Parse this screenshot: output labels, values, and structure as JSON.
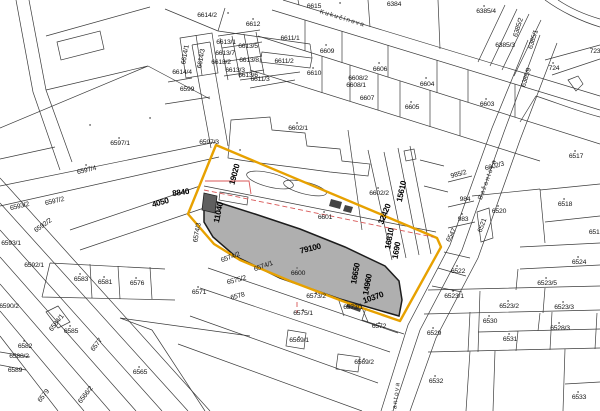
{
  "map": {
    "type": "cadastral-map",
    "colors": {
      "background": "#ffffff",
      "parcel_line": "#3c3c3c",
      "highlight_boundary": "#e7a100",
      "selected_parcel_fill": "#8c8c8c",
      "planning_line_red": "#d85757",
      "label_text": "#141414"
    },
    "streets": [
      {
        "text": "Kukučínova",
        "x": 342,
        "y": 20,
        "rot": 17
      },
      {
        "text": "Bažantova",
        "x": 489,
        "y": 180,
        "rot": -70
      },
      {
        "text": "Bažantova",
        "x": 397,
        "y": 403,
        "rot": -83
      }
    ],
    "measurements": [
      {
        "text": "4050",
        "x": 161,
        "y": 205,
        "rot": -16
      },
      {
        "text": "8840",
        "x": 181,
        "y": 195,
        "rot": -8
      },
      {
        "text": "19020",
        "x": 237,
        "y": 175,
        "rot": -75
      },
      {
        "text": "11040",
        "x": 221,
        "y": 213,
        "rot": -78
      },
      {
        "text": "79100",
        "x": 311,
        "y": 251,
        "rot": -14
      },
      {
        "text": "32420",
        "x": 387,
        "y": 215,
        "rot": -68
      },
      {
        "text": "15610",
        "x": 404,
        "y": 192,
        "rot": -78
      },
      {
        "text": "16810",
        "x": 392,
        "y": 239,
        "rot": -80
      },
      {
        "text": "1690",
        "x": 399,
        "y": 251,
        "rot": -80
      },
      {
        "text": "16650",
        "x": 358,
        "y": 274,
        "rot": -80
      },
      {
        "text": "14960",
        "x": 370,
        "y": 285,
        "rot": -80
      },
      {
        "text": "10370",
        "x": 374,
        "y": 300,
        "rot": -20
      }
    ],
    "parcels": [
      {
        "text": "6614/2",
        "x": 207,
        "y": 17
      },
      {
        "text": "6612",
        "x": 253,
        "y": 26
      },
      {
        "text": "6611/1",
        "x": 290,
        "y": 40
      },
      {
        "text": "6615",
        "x": 314,
        "y": 8
      },
      {
        "text": "6384",
        "x": 394,
        "y": 6
      },
      {
        "text": "6385/4",
        "x": 486,
        "y": 13
      },
      {
        "text": "6385/2",
        "x": 520,
        "y": 28,
        "rot": -72,
        "size": 5.5
      },
      {
        "text": "6385/1",
        "x": 535,
        "y": 40,
        "rot": -72
      },
      {
        "text": "6385/3",
        "x": 505,
        "y": 47,
        "size": 5.5
      },
      {
        "text": "724",
        "x": 554,
        "y": 70
      },
      {
        "text": "723",
        "x": 595,
        "y": 53
      },
      {
        "text": "6385/9",
        "x": 528,
        "y": 78,
        "rot": -72,
        "size": 5
      },
      {
        "text": "6609",
        "x": 327,
        "y": 53
      },
      {
        "text": "6610",
        "x": 314,
        "y": 75
      },
      {
        "text": "6606",
        "x": 380,
        "y": 71
      },
      {
        "text": "6608/2",
        "x": 358,
        "y": 80,
        "size": 5
      },
      {
        "text": "6608/1",
        "x": 356,
        "y": 87,
        "size": 5
      },
      {
        "text": "6607",
        "x": 367,
        "y": 100
      },
      {
        "text": "6604",
        "x": 427,
        "y": 86
      },
      {
        "text": "6605",
        "x": 412,
        "y": 109
      },
      {
        "text": "6603",
        "x": 487,
        "y": 106
      },
      {
        "text": "6614/1",
        "x": 187,
        "y": 55,
        "rot": -80,
        "size": 5.8
      },
      {
        "text": "6614/3",
        "x": 203,
        "y": 59,
        "rot": -80,
        "size": 5.8
      },
      {
        "text": "6614/4",
        "x": 182,
        "y": 74,
        "size": 5.5
      },
      {
        "text": "6599",
        "x": 187,
        "y": 91
      },
      {
        "text": "6613/1",
        "x": 226,
        "y": 44,
        "size": 4.6
      },
      {
        "text": "6613/5",
        "x": 248,
        "y": 48,
        "size": 4.6
      },
      {
        "text": "6613/7",
        "x": 225,
        "y": 55,
        "size": 4.6
      },
      {
        "text": "6613/8",
        "x": 249,
        "y": 62,
        "size": 4.6
      },
      {
        "text": "6613/2",
        "x": 221,
        "y": 64,
        "size": 4.6
      },
      {
        "text": "6613/3",
        "x": 235,
        "y": 72,
        "size": 4.6
      },
      {
        "text": "6613/6",
        "x": 248,
        "y": 77,
        "size": 4.6
      },
      {
        "text": "6611/2",
        "x": 284,
        "y": 63
      },
      {
        "text": "6611/3",
        "x": 260,
        "y": 81,
        "size": 5.5
      },
      {
        "text": "6597/3",
        "x": 209,
        "y": 144
      },
      {
        "text": "6597/1",
        "x": 120,
        "y": 145
      },
      {
        "text": "6597/4",
        "x": 87,
        "y": 172,
        "rot": -13
      },
      {
        "text": "6597/2",
        "x": 55,
        "y": 203,
        "rot": -13
      },
      {
        "text": "6593/2",
        "x": 20,
        "y": 208,
        "rot": -13
      },
      {
        "text": "6592/2",
        "x": 44,
        "y": 227,
        "rot": -35,
        "size": 5.5
      },
      {
        "text": "6593/1",
        "x": 11,
        "y": 245
      },
      {
        "text": "6592/1",
        "x": 34,
        "y": 267
      },
      {
        "text": "6583",
        "x": 81,
        "y": 281
      },
      {
        "text": "6581",
        "x": 105,
        "y": 284
      },
      {
        "text": "6576",
        "x": 137,
        "y": 285
      },
      {
        "text": "6571",
        "x": 199,
        "y": 294
      },
      {
        "text": "6590/2",
        "x": 9,
        "y": 308
      },
      {
        "text": "6585",
        "x": 71,
        "y": 333
      },
      {
        "text": "6584/1",
        "x": 58,
        "y": 324,
        "rot": -52,
        "size": 5
      },
      {
        "text": "6582",
        "x": 25,
        "y": 348
      },
      {
        "text": "6588/2",
        "x": 19,
        "y": 358,
        "size": 5.5
      },
      {
        "text": "6589",
        "x": 15,
        "y": 372
      },
      {
        "text": "6577",
        "x": 98,
        "y": 346,
        "rot": -52
      },
      {
        "text": "6579",
        "x": 45,
        "y": 397,
        "rot": -52
      },
      {
        "text": "6566/2",
        "x": 87,
        "y": 396,
        "rot": -52
      },
      {
        "text": "6565",
        "x": 140,
        "y": 374
      },
      {
        "text": "6574/3",
        "x": 199,
        "y": 233,
        "rot": -80,
        "size": 5
      },
      {
        "text": "6574/2",
        "x": 231,
        "y": 259,
        "rot": -20
      },
      {
        "text": "6574/1",
        "x": 264,
        "y": 268,
        "rot": -20
      },
      {
        "text": "6575/2",
        "x": 237,
        "y": 282,
        "rot": -15
      },
      {
        "text": "6578",
        "x": 238,
        "y": 298,
        "rot": -15,
        "size": 5.5
      },
      {
        "text": "6600",
        "x": 298,
        "y": 275
      },
      {
        "text": "6601",
        "x": 325,
        "y": 219
      },
      {
        "text": "6602/1",
        "x": 298,
        "y": 130
      },
      {
        "text": "6602/2",
        "x": 379,
        "y": 195
      },
      {
        "text": "6602/3",
        "x": 495,
        "y": 168,
        "rot": -15,
        "size": 5.5
      },
      {
        "text": "985/2",
        "x": 459,
        "y": 176,
        "rot": -15,
        "size": 5.5
      },
      {
        "text": "984",
        "x": 465,
        "y": 201,
        "size": 6
      },
      {
        "text": "983",
        "x": 463,
        "y": 221
      },
      {
        "text": "6547",
        "x": 453,
        "y": 236,
        "rot": -62
      },
      {
        "text": "6522",
        "x": 458,
        "y": 273
      },
      {
        "text": "6520",
        "x": 499,
        "y": 213
      },
      {
        "text": "6521",
        "x": 484,
        "y": 226,
        "rot": -70,
        "size": 5
      },
      {
        "text": "6518",
        "x": 565,
        "y": 206
      },
      {
        "text": "6519",
        "x": 596,
        "y": 234
      },
      {
        "text": "6517",
        "x": 576,
        "y": 158
      },
      {
        "text": "6524",
        "x": 579,
        "y": 264
      },
      {
        "text": "6523/5",
        "x": 547,
        "y": 285
      },
      {
        "text": "6523/1",
        "x": 454,
        "y": 298
      },
      {
        "text": "6523/2",
        "x": 509,
        "y": 308
      },
      {
        "text": "6523/3",
        "x": 564,
        "y": 309
      },
      {
        "text": "6530",
        "x": 490,
        "y": 323
      },
      {
        "text": "6528/3",
        "x": 560,
        "y": 330
      },
      {
        "text": "6529",
        "x": 434,
        "y": 335
      },
      {
        "text": "6531",
        "x": 510,
        "y": 341
      },
      {
        "text": "6532",
        "x": 436,
        "y": 383
      },
      {
        "text": "6533",
        "x": 579,
        "y": 399
      },
      {
        "text": "6573/2",
        "x": 316,
        "y": 298
      },
      {
        "text": "6573/1",
        "x": 353,
        "y": 309,
        "size": 5.5
      },
      {
        "text": "6575/1",
        "x": 303,
        "y": 315
      },
      {
        "text": "6572",
        "x": 379,
        "y": 328
      },
      {
        "text": "6569/1",
        "x": 299,
        "y": 342
      },
      {
        "text": "6569/2",
        "x": 364,
        "y": 364
      }
    ]
  }
}
